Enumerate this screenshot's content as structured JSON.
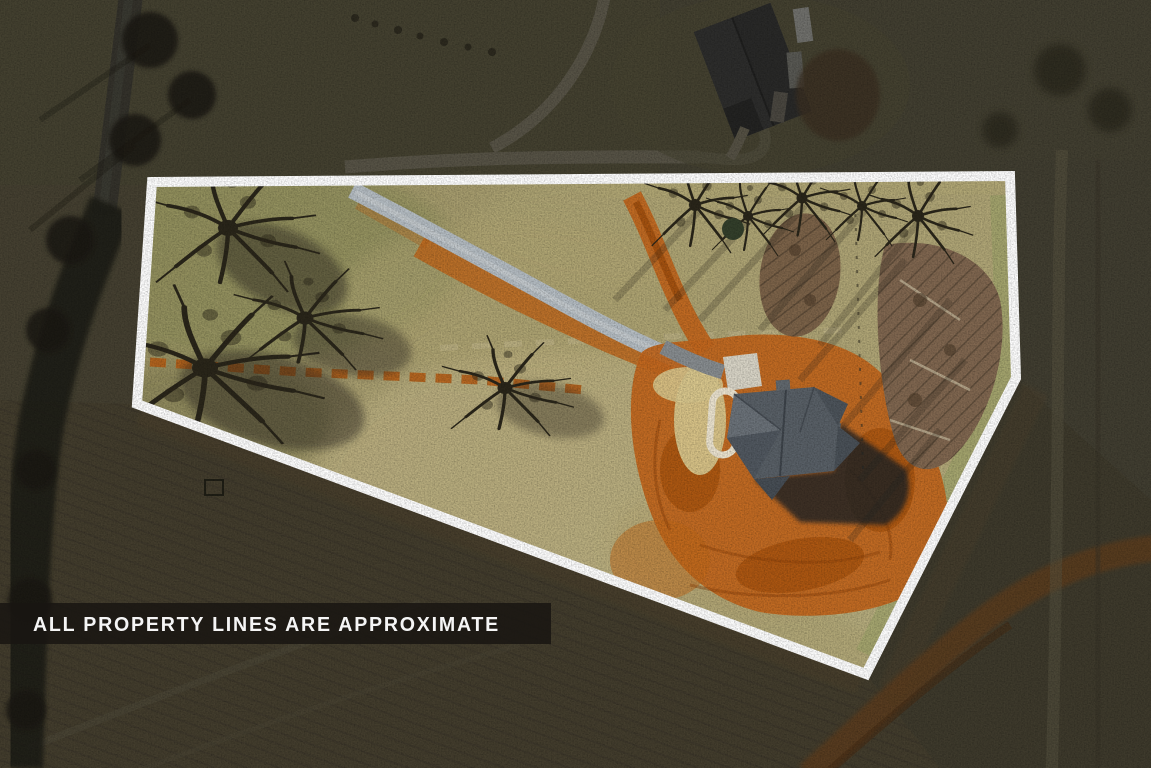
{
  "banner": {
    "text": "ALL PROPERTY LINES ARE APPROXIMATE"
  },
  "colors": {
    "boundary_white": "#ffffff",
    "outside_shade": "rgba(12,11,8,0.42)",
    "grass_tan": "#a89d6c",
    "dirt_orange": "#c2671f",
    "dirt_orange_deep": "#a8540f",
    "driveway_gray": "#b5bdc3",
    "roof_gray": "#596067",
    "banner_bg": "rgba(24,21,17,0.86)",
    "banner_text": "#f5f5f5"
  }
}
